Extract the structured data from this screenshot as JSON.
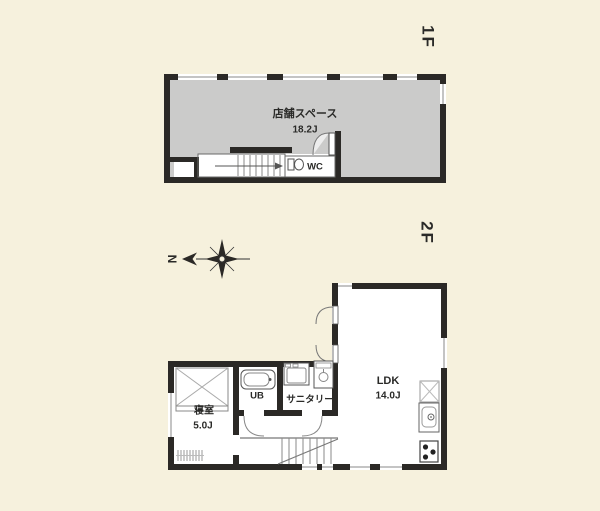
{
  "colors": {
    "background": "#f6f1dd",
    "wall": "#2b2926",
    "shop_fill": "#cbcbca",
    "room_fill": "#ffffff",
    "thin_line": "#777777",
    "text": "#2a2a28"
  },
  "floor_1f": {
    "label": "1F",
    "shop": {
      "name": "店舗スペース",
      "area": "18.2J"
    },
    "wc_label": "WC"
  },
  "floor_2f": {
    "label": "2F",
    "ldk": {
      "name": "LDK",
      "area": "14.0J"
    },
    "bedroom": {
      "name": "寝室",
      "area": "5.0J"
    },
    "bath_label": "UB",
    "sanitary_label": "サニタリー"
  },
  "compass": {
    "north_label": "N"
  }
}
